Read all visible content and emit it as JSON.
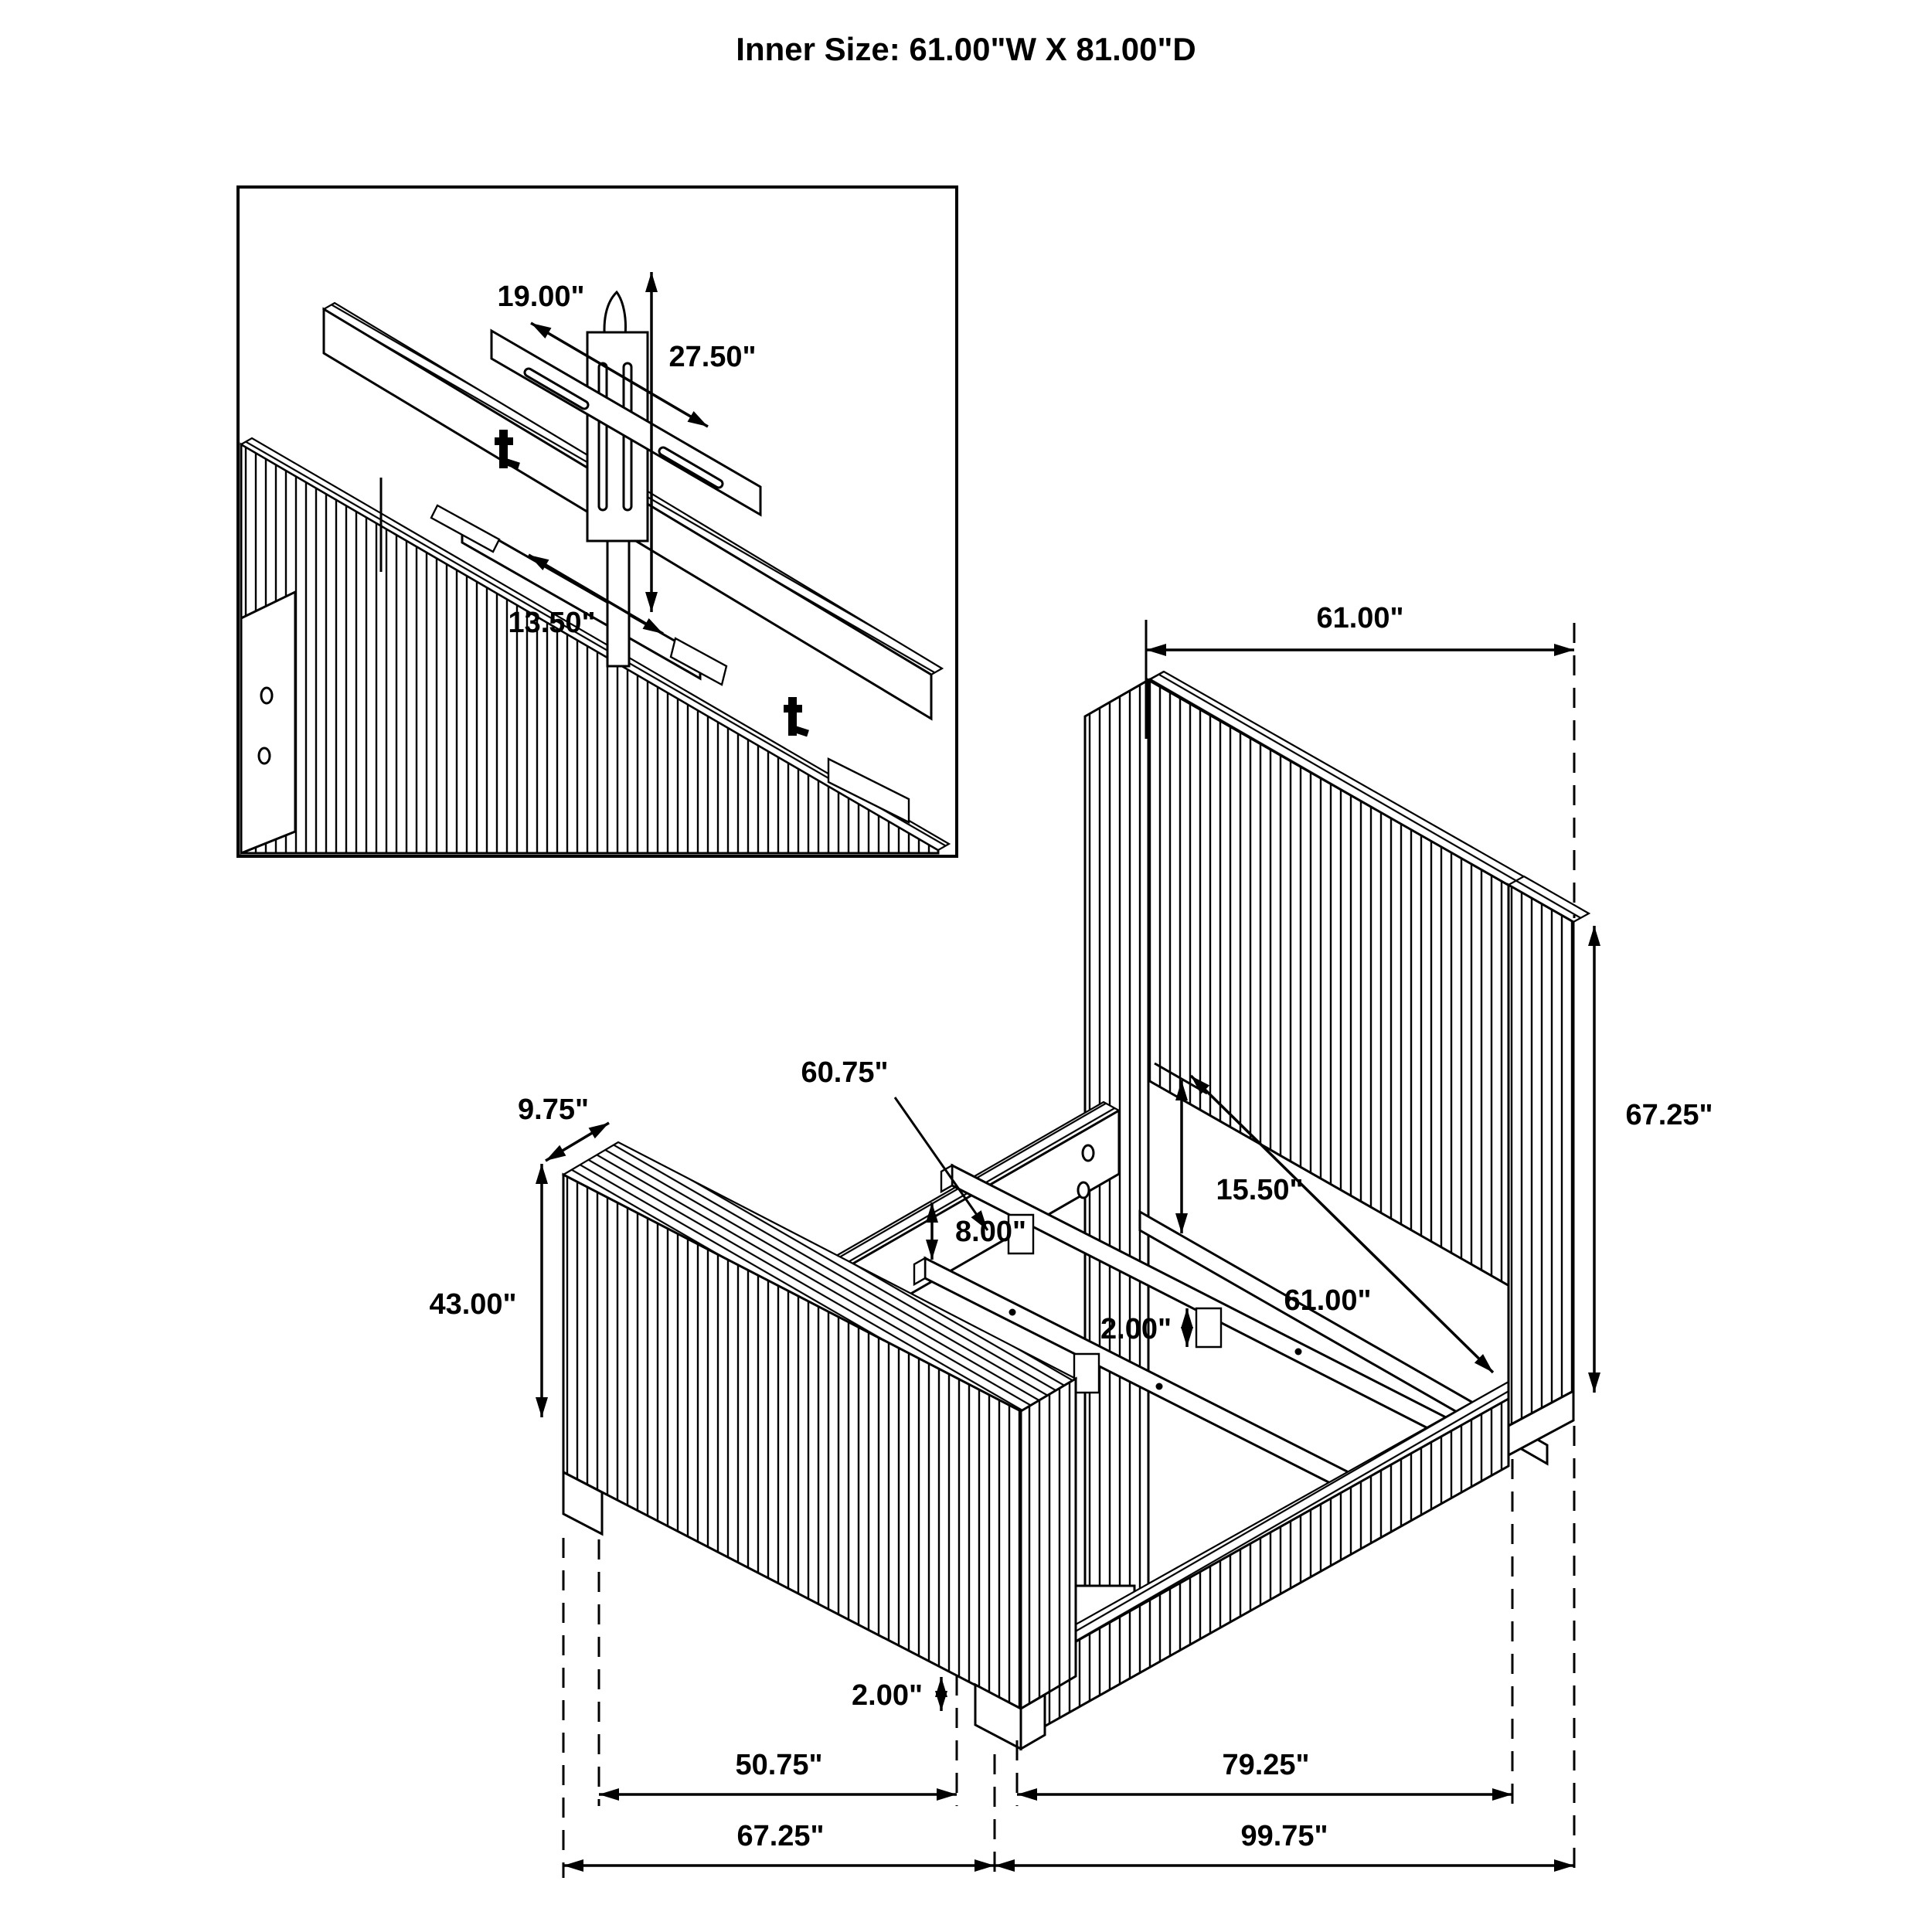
{
  "title": "Inner Size: 61.00\"W X 81.00\"D",
  "inset": {
    "bar_width_label": "19.00\"",
    "bracket_height_label": "27.50\"",
    "support_length_label": "13.50\""
  },
  "main": {
    "headboard_width_label": "61.00\"",
    "headboard_height_label": "67.25\"",
    "slat_length_label": "60.75\"",
    "footboard_depth_label": "9.75\"",
    "footboard_height_label": "43.00\"",
    "rail_to_platform_label": "15.50\"",
    "inner_width_label": "61.00\"",
    "rail_drop_label": "8.00\"",
    "slat_leg_height_label": "2.00\"",
    "foot_height_label": "2.00\"",
    "footboard_to_leg_label": "50.75\"",
    "leg_to_headboard_label": "79.25\"",
    "overall_depth_label": "67.25\"",
    "overall_length_label": "99.75\""
  }
}
